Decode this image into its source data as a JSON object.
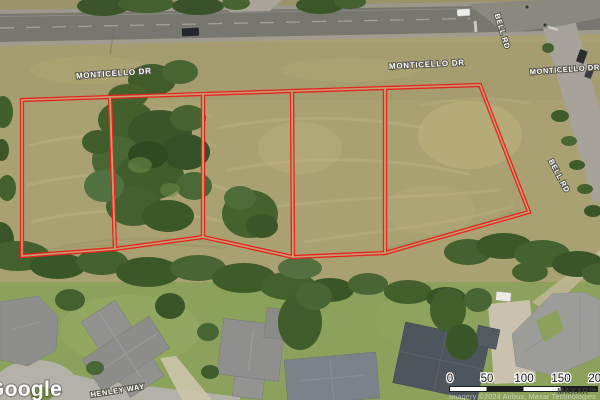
{
  "map": {
    "type": "satellite",
    "watermark_google": "Google",
    "watermark_imagery": "Imagery ©2024 Airbus, Maxar Technologies",
    "watermark_maxar": "MAXAR™",
    "street_labels": {
      "monticello_west": "MONTICELLO DR",
      "monticello_center": "MONTICELLO DR",
      "monticello_east": "MONTICELLO DR",
      "bell_rd_north": "BELL RD",
      "bell_rd_south": "BELL RD",
      "henley_way": "HENLEY WAY"
    },
    "scale_bar": {
      "ticks": [
        "0",
        "50",
        "100",
        "150",
        "200"
      ]
    },
    "parcels": {
      "count": 5,
      "outline_color": "#e8231d"
    },
    "colors": {
      "field": "#a9a172",
      "lawn": "#8ca25c",
      "trees": "#3b5628",
      "road": "#77766f"
    }
  }
}
